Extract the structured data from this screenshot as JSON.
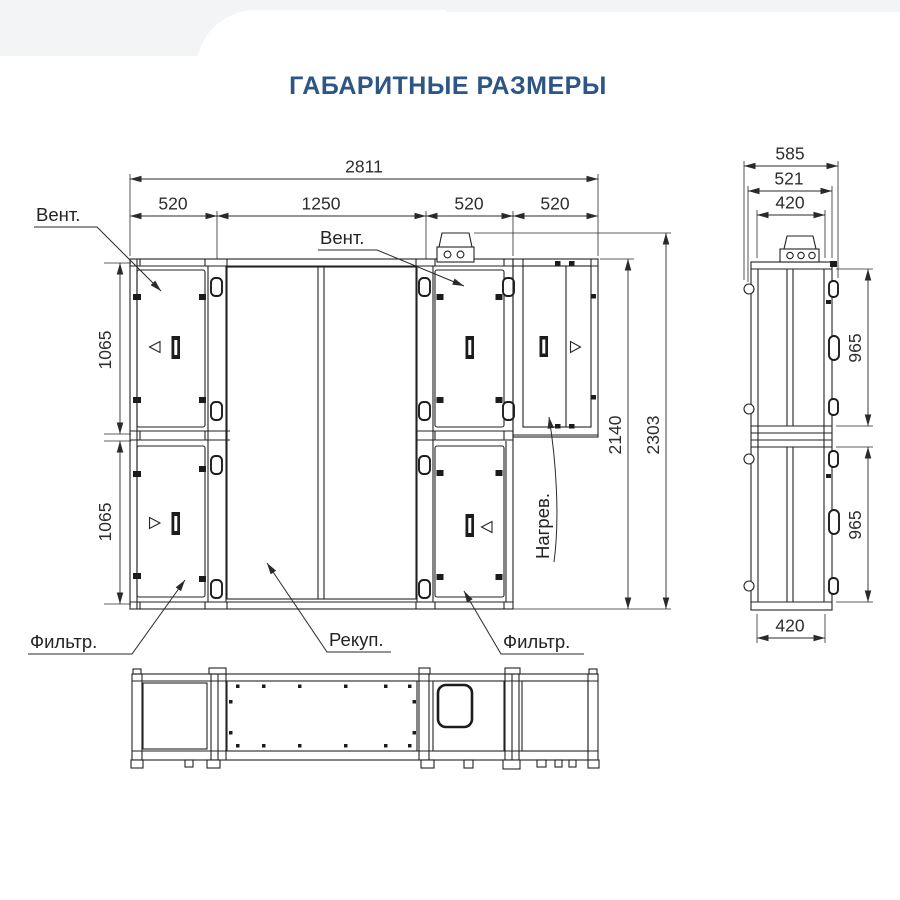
{
  "title": "ГАБАРИТНЫЕ РАЗМЕРЫ",
  "colors": {
    "title_accent": "#2d5585",
    "line": "#222222",
    "dim_text": "#2d2d2d",
    "background": "#ffffff"
  },
  "front_view": {
    "dim_width_total": "2811",
    "dim_width_fan_left": "520",
    "dim_width_recuperator": "1250",
    "dim_width_fan_right": "520",
    "dim_width_heater": "520",
    "dim_height_module_top": "1065",
    "dim_height_module_bottom": "1065",
    "dim_height_body": "2140",
    "dim_height_total": "2303",
    "label_fan_left": "Вент.",
    "label_fan_right": "Вент.",
    "label_heater": "Нагрев.",
    "label_filter_left": "Фильтр.",
    "label_recuperator": "Рекуп.",
    "label_filter_right": "Фильтр."
  },
  "side_view": {
    "dim_depth_total": "585",
    "dim_depth_door": "521",
    "dim_depth_body_top": "420",
    "dim_height_door_top": "965",
    "dim_height_door_bottom": "965",
    "dim_depth_body_bottom": "420"
  }
}
